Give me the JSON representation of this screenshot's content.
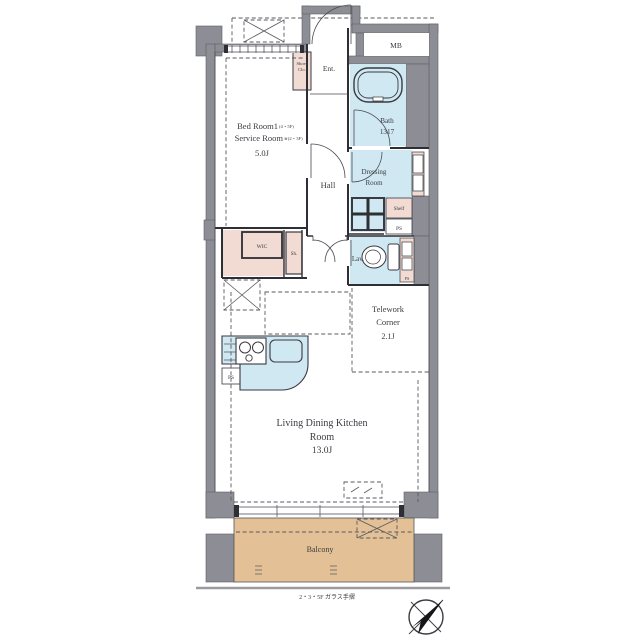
{
  "plan": {
    "rooms": {
      "bedroom": {
        "name": "Bed Room1",
        "name_note": "(4・5F)",
        "alt": "Service Room",
        "alt_note": "※(2・3F)",
        "size": "5.0J"
      },
      "entrance": {
        "label": "Ent."
      },
      "shoes_closet": {
        "line1": "Shoes",
        "line2": "Clo."
      },
      "meter_box": {
        "label": "MB"
      },
      "bath": {
        "label": "Bath",
        "size": "1317"
      },
      "hall": {
        "label": "Hall"
      },
      "dressing": {
        "line1": "Dressing",
        "line2": "Room"
      },
      "shelf": {
        "label": "Shelf"
      },
      "lavatory": {
        "label": "Lav."
      },
      "wic": {
        "label": "WIC"
      },
      "shelf_small": {
        "label": "Sh."
      },
      "pipe_space": {
        "label": "PS"
      },
      "telework": {
        "line1": "Telework",
        "line2": "Corner",
        "size": "2.1J"
      },
      "ldk": {
        "line1": "Living Dining Kitchen",
        "line2": "Room",
        "size": "13.0J"
      },
      "balcony": {
        "label": "Balcony"
      }
    },
    "caption": "2・3・5F ガラス手摺",
    "colors": {
      "wall_gray": "#8d8d95",
      "water_blue": "#cfe8f1",
      "closet_pink": "#f2dbd3",
      "balcony_tan": "#e3c096",
      "line": "#2e2e35"
    }
  }
}
